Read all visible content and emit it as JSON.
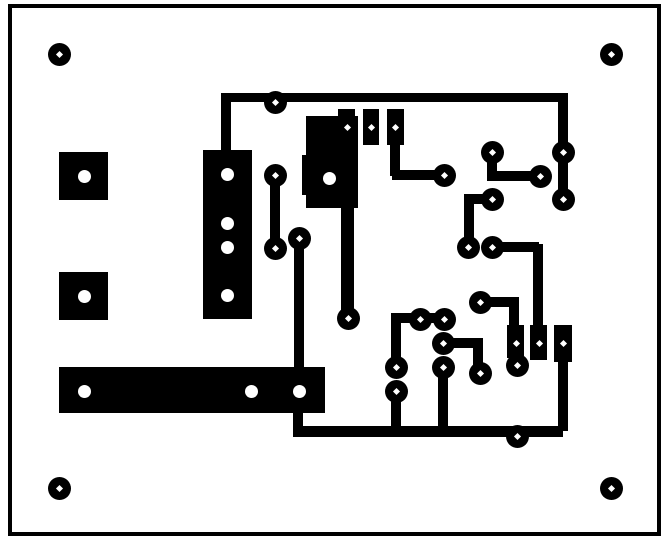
{
  "canvas": {
    "width": 669,
    "height": 547,
    "background_color": "#ffffff",
    "copper_color": "#000000",
    "hole_color": "#ffffff"
  },
  "board_outline": {
    "x": 8,
    "y": 4,
    "w": 653,
    "h": 532,
    "stroke": 4
  },
  "pad_diameter": 23,
  "mount_hole_diameter": 23,
  "hole_circle_diameter": 13,
  "hole_diamond_size": 5,
  "mounting_holes": [
    {
      "cx": 59,
      "cy": 54
    },
    {
      "cx": 611,
      "cy": 54
    },
    {
      "cx": 59,
      "cy": 488
    },
    {
      "cx": 611,
      "cy": 488
    }
  ],
  "traces": [
    [
      221,
      93,
      343,
      9
    ],
    [
      221,
      93,
      10,
      58
    ],
    [
      558,
      93,
      10,
      61
    ],
    [
      558,
      152,
      10,
      48
    ],
    [
      487,
      152,
      10,
      29
    ],
    [
      487,
      171,
      53,
      10
    ],
    [
      390,
      145,
      10,
      31
    ],
    [
      392,
      170,
      52,
      10
    ],
    [
      464,
      194,
      27,
      10
    ],
    [
      464,
      199,
      10,
      49
    ],
    [
      492,
      242,
      47,
      10
    ],
    [
      533,
      244,
      10,
      82
    ],
    [
      480,
      297,
      37,
      10
    ],
    [
      509,
      297,
      10,
      29
    ],
    [
      270,
      175,
      10,
      74
    ],
    [
      294,
      238,
      10,
      130
    ],
    [
      341,
      207,
      13,
      112
    ],
    [
      396,
      313,
      49,
      10
    ],
    [
      391,
      313,
      10,
      56
    ],
    [
      391,
      390,
      10,
      42
    ],
    [
      438,
      368,
      10,
      64
    ],
    [
      443,
      338,
      38,
      10
    ],
    [
      473,
      338,
      10,
      36
    ],
    [
      293,
      413,
      10,
      19
    ],
    [
      293,
      426,
      224,
      11
    ],
    [
      558,
      358,
      10,
      73
    ],
    [
      517,
      426,
      46,
      11
    ]
  ],
  "rect_pads": [
    {
      "x": 59,
      "y": 152,
      "w": 49,
      "h": 48,
      "holes": [
        {
          "type": "circle",
          "cx": 84,
          "cy": 176
        }
      ]
    },
    {
      "x": 59,
      "y": 272,
      "w": 49,
      "h": 48,
      "holes": [
        {
          "type": "circle",
          "cx": 84,
          "cy": 296
        }
      ]
    },
    {
      "x": 203,
      "y": 150,
      "w": 49,
      "h": 169,
      "holes": [
        {
          "type": "circle",
          "cx": 227,
          "cy": 174
        },
        {
          "type": "circle",
          "cx": 227,
          "cy": 223
        },
        {
          "type": "circle",
          "cx": 227,
          "cy": 247
        },
        {
          "type": "circle",
          "cx": 227,
          "cy": 295
        }
      ]
    },
    {
      "x": 306,
      "y": 116,
      "w": 52,
      "h": 92,
      "holes": [
        {
          "type": "circle",
          "cx": 329,
          "cy": 178
        }
      ]
    },
    {
      "x": 302,
      "y": 155,
      "w": 5,
      "h": 40,
      "holes": []
    },
    {
      "x": 59,
      "y": 367,
      "w": 266,
      "h": 46,
      "holes": [
        {
          "type": "circle",
          "cx": 84,
          "cy": 391
        },
        {
          "type": "circle",
          "cx": 251,
          "cy": 391
        },
        {
          "type": "circle",
          "cx": 299,
          "cy": 391
        }
      ]
    },
    {
      "x": 338,
      "y": 109,
      "w": 17,
      "h": 36,
      "holes": [
        {
          "type": "diamond",
          "cx": 347,
          "cy": 127
        }
      ]
    },
    {
      "x": 363,
      "y": 109,
      "w": 16,
      "h": 36,
      "holes": [
        {
          "type": "diamond",
          "cx": 371,
          "cy": 127
        }
      ]
    },
    {
      "x": 387,
      "y": 109,
      "w": 17,
      "h": 36,
      "holes": [
        {
          "type": "diamond",
          "cx": 395,
          "cy": 127
        }
      ]
    },
    {
      "x": 507,
      "y": 325,
      "w": 17,
      "h": 33,
      "holes": [
        {
          "type": "diamond",
          "cx": 516,
          "cy": 343
        }
      ]
    },
    {
      "x": 530,
      "y": 325,
      "w": 17,
      "h": 35,
      "holes": [
        {
          "type": "diamond",
          "cx": 539,
          "cy": 343
        }
      ]
    },
    {
      "x": 554,
      "y": 325,
      "w": 18,
      "h": 37,
      "holes": [
        {
          "type": "diamond",
          "cx": 563,
          "cy": 343
        }
      ]
    }
  ],
  "round_pads": [
    {
      "cx": 275,
      "cy": 102
    },
    {
      "cx": 275,
      "cy": 175
    },
    {
      "cx": 275,
      "cy": 248
    },
    {
      "cx": 299,
      "cy": 238
    },
    {
      "cx": 348,
      "cy": 318
    },
    {
      "cx": 444,
      "cy": 175
    },
    {
      "cx": 492,
      "cy": 152
    },
    {
      "cx": 540,
      "cy": 176
    },
    {
      "cx": 563,
      "cy": 152
    },
    {
      "cx": 563,
      "cy": 199
    },
    {
      "cx": 492,
      "cy": 199
    },
    {
      "cx": 468,
      "cy": 247
    },
    {
      "cx": 492,
      "cy": 247
    },
    {
      "cx": 420,
      "cy": 319
    },
    {
      "cx": 444,
      "cy": 319
    },
    {
      "cx": 443,
      "cy": 343
    },
    {
      "cx": 480,
      "cy": 373
    },
    {
      "cx": 443,
      "cy": 367
    },
    {
      "cx": 396,
      "cy": 367
    },
    {
      "cx": 396,
      "cy": 391
    },
    {
      "cx": 480,
      "cy": 302
    },
    {
      "cx": 517,
      "cy": 365
    },
    {
      "cx": 517,
      "cy": 436
    }
  ]
}
